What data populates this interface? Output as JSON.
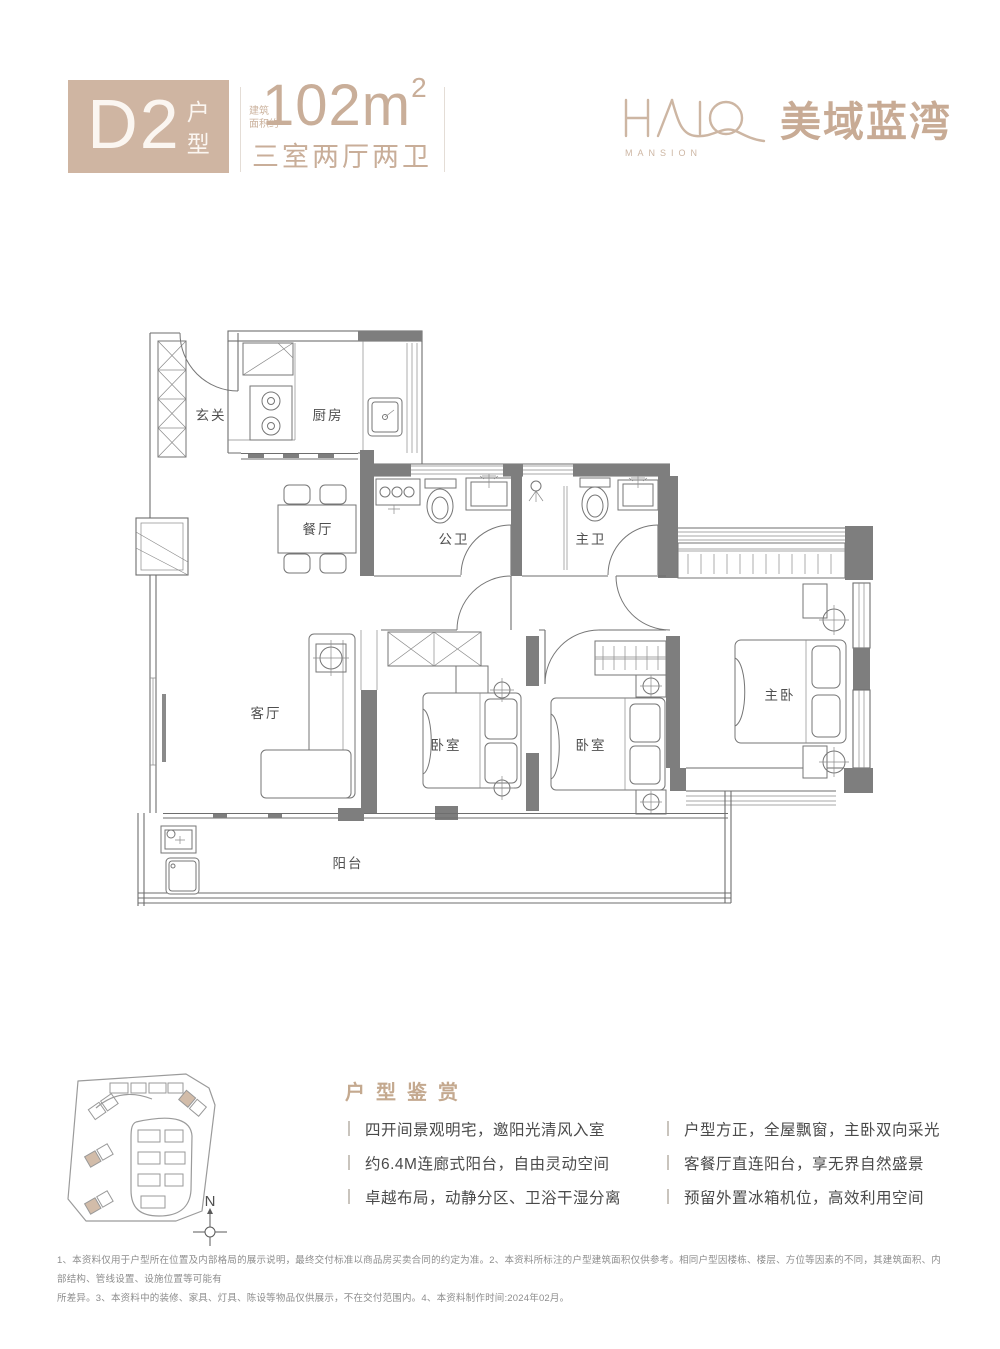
{
  "header": {
    "unit_code": "D2",
    "unit_suffix_top": "户",
    "unit_suffix_bottom": "型",
    "area_note_line1": "建筑",
    "area_note_line2": "面积约",
    "area_value": "102m",
    "area_sup": "2",
    "layout_desc": "三室两厅两卫",
    "logo": {
      "halo": "HALO",
      "mansion": "MANSION",
      "name_cn": "美域蓝湾"
    }
  },
  "plan": {
    "rooms": {
      "entry": "玄关",
      "kitchen": "厨房",
      "dining": "餐厅",
      "bath_public": "公卫",
      "bath_master": "主卫",
      "living": "客厅",
      "bedroom": "卧室",
      "master_bedroom": "主卧",
      "balcony": "阳台"
    }
  },
  "sitemap": {
    "compass_north": "N"
  },
  "features": {
    "title": "户型鉴赏",
    "left": [
      "四开间景观明宅，邀阳光清风入室",
      "约6.4M连廊式阳台，自由灵动空间",
      "卓越布局，动静分区、卫浴干湿分离"
    ],
    "right": [
      "户型方正，全屋飘窗，主卧双向采光",
      "客餐厅直连阳台，享无界自然盛景",
      "预留外置冰箱机位，高效利用空间"
    ]
  },
  "disclaimer": {
    "line1": "1、本资料仅用于户型所在位置及内部格局的展示说明，最终交付标准以商品房买卖合同的约定为准。2、本资料所标注的户型建筑面积仅供参考。相同户型因楼栋、楼层、方位等因素的不同，其建筑面积、内部结构、管线设置、设施位置等可能有",
    "line2": "所差异。3、本资料中的装修、家具、灯具、陈设等物品仅供展示，不在交付范围内。4、本资料制作时间:2024年02月。"
  },
  "colors": {
    "accent_beige": "#cfb5a2",
    "text_dark": "#4a4a4a",
    "wall_gray": "#7e7e7e"
  }
}
